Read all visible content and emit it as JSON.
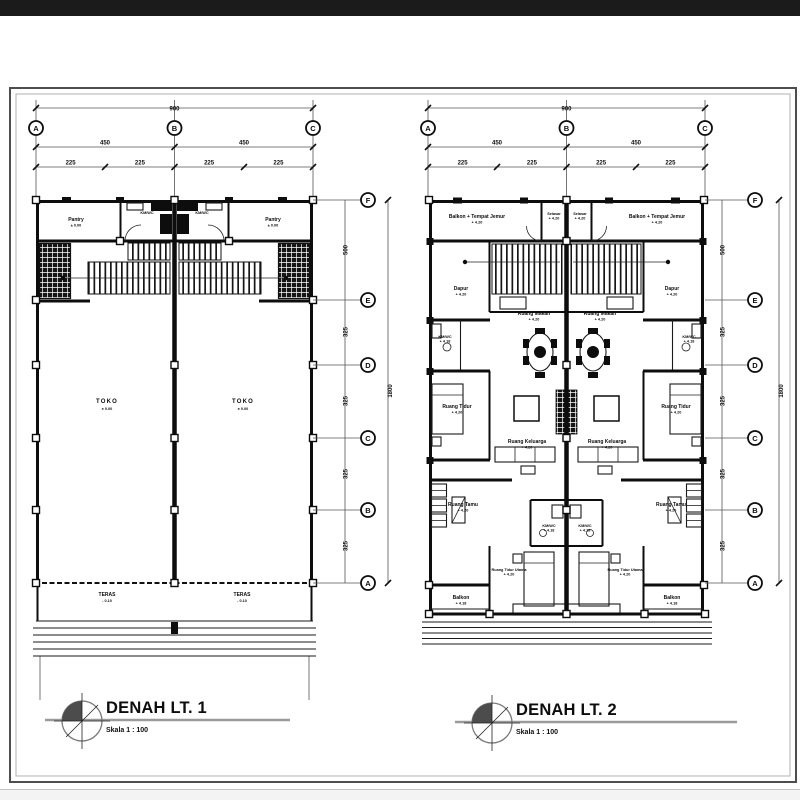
{
  "plans": [
    {
      "title": "DENAH LT. 1",
      "subtitle": "Skala 1 : 100",
      "grid": {
        "cols": [
          "A",
          "B",
          "C"
        ],
        "rows": [
          "F",
          "E",
          "D",
          "C",
          "B",
          "A"
        ]
      },
      "dims": {
        "tw": "900",
        "h1": "450",
        "h2": "450",
        "q1": "225",
        "q2": "225",
        "q3": "225",
        "q4": "225",
        "th": "1800",
        "r1": "500",
        "r2": "325",
        "r3": "325",
        "r4": "325",
        "r5": "325"
      },
      "rooms": {
        "pantry_l": {
          "n": "Pantry",
          "e": "± 0.00"
        },
        "pantry_r": {
          "n": "Pantry",
          "e": "± 0.00"
        },
        "km_l": {
          "n": "KM/WC",
          "e": "- 0.02"
        },
        "km_r": {
          "n": "KM/WC",
          "e": "- 0.02"
        },
        "toko_l": {
          "n": "TOKO",
          "e": "± 0.00"
        },
        "toko_r": {
          "n": "TOKO",
          "e": "± 0.00"
        },
        "teras_l": {
          "n": "TERAS",
          "e": "- 0.10"
        },
        "teras_r": {
          "n": "TERAS",
          "e": "- 0.10"
        }
      }
    },
    {
      "title": "DENAH LT. 2",
      "subtitle": "Skala 1 : 100",
      "grid": {
        "cols": [
          "A",
          "B",
          "C"
        ],
        "rows": [
          "F",
          "E",
          "D",
          "C",
          "B",
          "A"
        ]
      },
      "dims": {
        "tw": "900",
        "h1": "450",
        "h2": "450",
        "q1": "225",
        "q2": "225",
        "q3": "225",
        "q4": "225",
        "th": "1800",
        "r1": "500",
        "r2": "325",
        "r3": "325",
        "r4": "325",
        "r5": "325"
      },
      "rooms": {
        "bj_l": {
          "n": "Balkon + Tempat Jemur",
          "e": "+ 4.20"
        },
        "bj_r": {
          "n": "Balkon + Tempat Jemur",
          "e": "+ 4.20"
        },
        "sel_l": {
          "n": "Selasar",
          "e": "+ 4.20"
        },
        "sel_r": {
          "n": "Selasar",
          "e": "+ 4.20"
        },
        "dap_l": {
          "n": "Dapur",
          "e": "+ 4.20"
        },
        "dap_r": {
          "n": "Dapur",
          "e": "+ 4.20"
        },
        "rm_l": {
          "n": "Ruang Makan",
          "e": "+ 4.20"
        },
        "rm_r": {
          "n": "Ruang Makan",
          "e": "+ 4.20"
        },
        "km_l": {
          "n": "KM/WC",
          "e": "+ 4.18"
        },
        "km_r": {
          "n": "KM/WC",
          "e": "+ 4.18"
        },
        "rt_l": {
          "n": "Ruang Tidur",
          "e": "+ 4.20"
        },
        "rt_r": {
          "n": "Ruang Tidur",
          "e": "+ 4.20"
        },
        "rk_l": {
          "n": "Ruang Keluarga",
          "e": "+ 4.20"
        },
        "rk_r": {
          "n": "Ruang Keluarga",
          "e": "+ 4.20"
        },
        "tm_l": {
          "n": "Ruang Tamu",
          "e": "+ 4.20"
        },
        "tm_r": {
          "n": "Ruang Tamu",
          "e": "+ 4.20"
        },
        "km2_l": {
          "n": "KM/WC",
          "e": "+ 4.18"
        },
        "km2_r": {
          "n": "KM/WC",
          "e": "+ 4.18"
        },
        "ut_l": {
          "n": "Ruang Tidur Utama",
          "e": "+ 4.20"
        },
        "ut_r": {
          "n": "Ruang Tidur Utama",
          "e": "+ 4.20"
        },
        "bk_l": {
          "n": "Balkon",
          "e": "+ 4.18"
        },
        "bk_r": {
          "n": "Balkon",
          "e": "+ 4.18"
        }
      }
    }
  ]
}
